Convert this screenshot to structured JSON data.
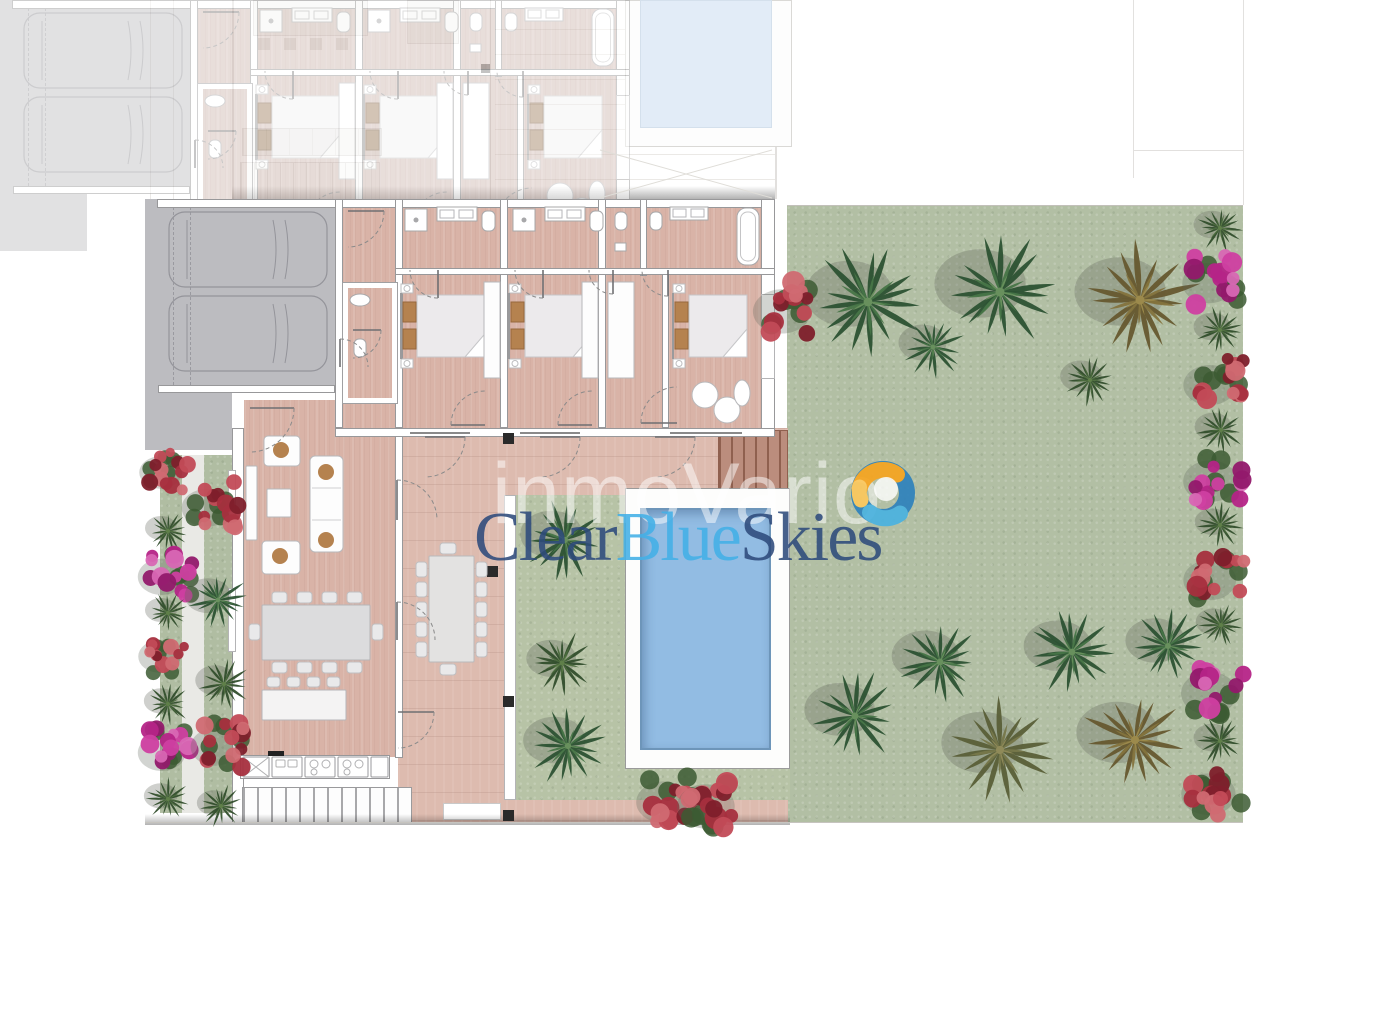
{
  "watermark": {
    "overlay_text": "inmoVario",
    "brand": {
      "clear": "Clear",
      "blue": "Blue",
      "skies": "Skies"
    },
    "colors": {
      "navy": "#2e4b7c",
      "light_blue": "#43b0e7",
      "overlay_white": "rgba(255,255,255,0.5)",
      "swirl_orange": "#f6a41f",
      "swirl_yellow": "#fcc85d",
      "swirl_blue": "#2e82bc",
      "swirl_light_blue": "#4ab2e0"
    }
  },
  "palette": {
    "floor": "#d9b3a7",
    "terrace": "#ddbbaf",
    "wall_line": "#98989a",
    "garage_gray": "#bcbcc0",
    "garden": "#b2bfa4",
    "garden_inner": "#b7c3a6",
    "pool_water": "#92bce3",
    "pool_edge": "#6d95b9",
    "neighbor_pool": "#d0e0f2",
    "deck_wood": "#bb8d7d",
    "pillow_brown": "#b5824f",
    "plant_magenta": "#b52487",
    "plant_red": "#a62f3e",
    "palm_green": "#2c5233",
    "palm_brown": "#66592f"
  },
  "garden": {
    "plants": [
      [
        "palm",
        868,
        302,
        55
      ],
      [
        "palm",
        933,
        347,
        30
      ],
      [
        "palm",
        1000,
        292,
        57
      ],
      [
        "bush",
        1090,
        380,
        26
      ],
      [
        "palmb",
        1140,
        300,
        57
      ],
      [
        "bgr",
        792,
        308,
        34
      ],
      [
        "bush",
        1220,
        228,
        23
      ],
      [
        "bgm",
        1218,
        280,
        31
      ],
      [
        "bush",
        1220,
        330,
        23
      ],
      [
        "bgr",
        1219,
        382,
        31
      ],
      [
        "bush",
        1221,
        430,
        23
      ],
      [
        "bgm",
        1220,
        478,
        32
      ],
      [
        "bush",
        1220,
        525,
        22
      ],
      [
        "bgr",
        1219,
        577,
        31
      ],
      [
        "bush",
        1221,
        625,
        22
      ],
      [
        "bgm",
        1219,
        690,
        33
      ],
      [
        "bush",
        1220,
        741,
        23
      ],
      [
        "bgr",
        1218,
        791,
        32
      ],
      [
        "palm",
        855,
        716,
        44
      ],
      [
        "palm",
        940,
        662,
        42
      ],
      [
        "palmo",
        1000,
        750,
        51
      ],
      [
        "palm",
        1072,
        652,
        42
      ],
      [
        "palmb",
        1135,
        740,
        51
      ],
      [
        "palm",
        1168,
        646,
        37
      ],
      [
        "palm",
        565,
        540,
        39
      ],
      [
        "bush",
        562,
        663,
        31
      ],
      [
        "palm",
        568,
        746,
        39
      ],
      [
        "bgr",
        673,
        799,
        32
      ],
      [
        "bgr",
        716,
        803,
        34
      ],
      [
        "bgr",
        168,
        470,
        25
      ],
      [
        "bush",
        168,
        531,
        20
      ],
      [
        "bgm",
        170,
        574,
        28
      ],
      [
        "bush",
        168,
        613,
        20
      ],
      [
        "bgr",
        167,
        654,
        25
      ],
      [
        "bush",
        168,
        704,
        21
      ],
      [
        "bgm",
        170,
        750,
        28
      ],
      [
        "bush",
        168,
        799,
        21
      ],
      [
        "bgr",
        215,
        505,
        29
      ],
      [
        "palm",
        218,
        600,
        29
      ],
      [
        "bush",
        224,
        684,
        25
      ],
      [
        "bgr",
        224,
        744,
        29
      ],
      [
        "bush",
        221,
        806,
        21
      ]
    ]
  },
  "structure": {
    "pillars": [
      [
        503,
        433
      ],
      [
        487,
        566
      ],
      [
        503,
        696
      ],
      [
        503,
        810
      ]
    ],
    "door_arcs_main": [
      [
        250,
        408,
        44,
        90
      ],
      [
        397,
        520,
        40,
        0
      ],
      [
        397,
        640,
        38,
        0
      ],
      [
        398,
        712,
        36,
        90
      ],
      [
        425,
        437,
        40,
        90
      ],
      [
        540,
        437,
        40,
        90
      ],
      [
        655,
        437,
        40,
        90
      ]
    ],
    "door_arcs_wing": [
      [
        203,
        12,
        36,
        90
      ],
      [
        293,
        71,
        28,
        180
      ],
      [
        398,
        71,
        28,
        180
      ],
      [
        468,
        71,
        24,
        180
      ],
      [
        523,
        71,
        26,
        180
      ],
      [
        208,
        131,
        28,
        90
      ],
      [
        340,
        226,
        34,
        270
      ],
      [
        447,
        226,
        34,
        270
      ],
      [
        532,
        224,
        36,
        270
      ],
      [
        195,
        168,
        28,
        0
      ]
    ],
    "cars": [
      [
        24,
        13
      ],
      [
        24,
        97
      ]
    ],
    "beds_wing": [
      [
        258,
        96,
        86
      ],
      [
        366,
        96,
        86
      ],
      [
        530,
        96,
        72
      ]
    ],
    "wardrobes_wing": [
      [
        339,
        83,
        16,
        96
      ],
      [
        437,
        83,
        16,
        96
      ],
      [
        463,
        83,
        26,
        96
      ]
    ],
    "counter_modules": [
      [
        243,
        26
      ],
      [
        272,
        30
      ],
      [
        305,
        30
      ],
      [
        338,
        30
      ],
      [
        371,
        17
      ]
    ]
  }
}
